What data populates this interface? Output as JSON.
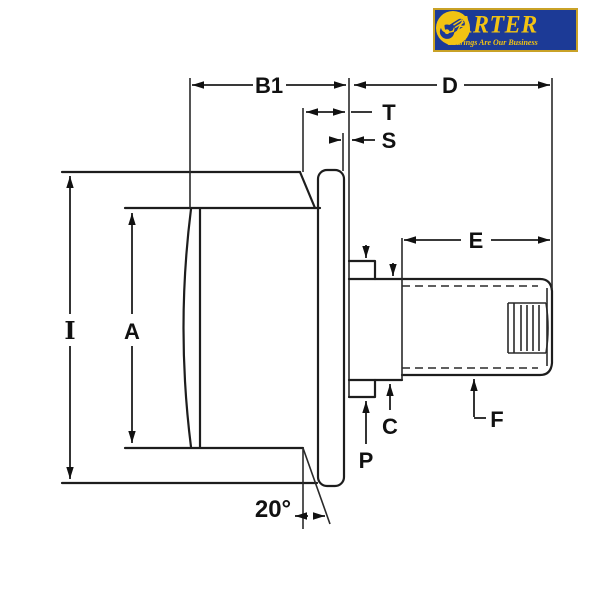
{
  "logo": {
    "brand": "CARTER",
    "tagline": "Bearings Are Our Business",
    "colors": {
      "background": "#1c3a96",
      "accent": "#f2c313",
      "border": "#c9a227"
    }
  },
  "dimensions": {
    "b1": "B1",
    "d": "D",
    "t": "T",
    "s": "S",
    "e": "E",
    "i": "I",
    "a": "A",
    "c": "C",
    "p": "P",
    "f": "F",
    "angle": "20°"
  },
  "drawing": {
    "line_color": "#1d1d1d"
  }
}
